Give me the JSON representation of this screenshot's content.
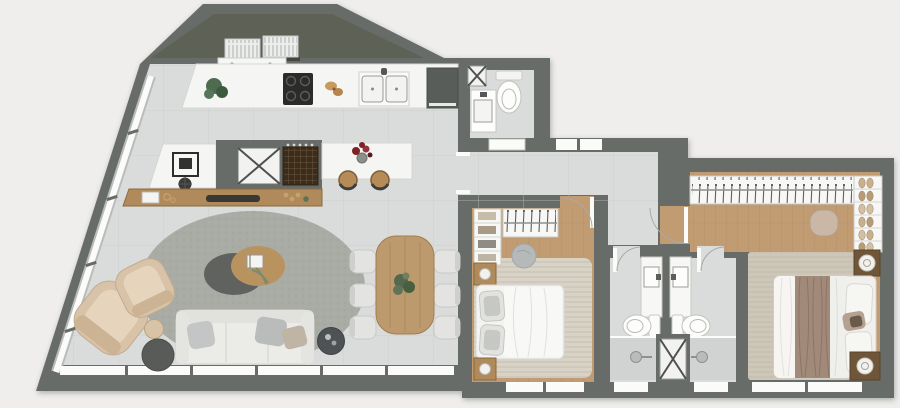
{
  "meta": {
    "title": "Apartment floor plan – rendered top view, no text labels",
    "canvas": {
      "width": 900,
      "height": 408
    }
  },
  "palette": {
    "bg": "#efeeec",
    "wall": "#686c68",
    "tile": "#dadcdb",
    "tile_line": "#c7cac9",
    "wood": "#c19b72",
    "wood_line": "#ad8a61",
    "service_floor": "#5e6156",
    "counter": "#f5f5f3",
    "counter_edge": "#d6d6d2",
    "rug_gray": "#a9aba5",
    "rug_beige": "#d8d3c5",
    "rug_master": "#cdc7b8",
    "white_furniture": "#f4f4f2",
    "sofa": "#ebebe8",
    "armchair": "#d9c3a8",
    "wood_furniture": "#b08a5a",
    "dark_accent": "#54575a",
    "green_plant": "#4e6b4f",
    "red_flowers": "#7e2125",
    "gold": "#c2a36b",
    "window": "#fbfbfa",
    "bed_throw": "#a18a79",
    "wine_rack": "#3a2d1e"
  },
  "inventory": {
    "rooms": [
      {
        "id": "service-area",
        "items": [
          "ac-condenser-1",
          "ac-condenser-2",
          "wall-shelf"
        ]
      },
      {
        "id": "kitchen",
        "items": [
          "countertop",
          "hood-shelf",
          "potted-plant",
          "cooktop",
          "bread",
          "double-sink",
          "refrigerator"
        ]
      },
      {
        "id": "powder-room",
        "items": [
          "toilet",
          "washbasin",
          "shaft"
        ]
      },
      {
        "id": "island-area",
        "items": [
          "side-counter",
          "coffee-station",
          "counter-stool",
          "utility-cabinet",
          "wine-rack",
          "island-counter",
          "flower-vase",
          "bar-stool-1",
          "bar-stool-2"
        ]
      },
      {
        "id": "living-room",
        "items": [
          "sideboard",
          "soundbar",
          "decor-objects",
          "area-rug",
          "sofa",
          "throw-pillows",
          "armchair-1",
          "armchair-2",
          "side-table",
          "ottoman",
          "planter",
          "coffee-table",
          "book",
          "leaf-decor"
        ]
      },
      {
        "id": "dining-area",
        "items": [
          "dining-table",
          "centerpiece-plant",
          "dining-chair-1",
          "dining-chair-2",
          "dining-chair-3",
          "dining-chair-4",
          "dining-chair-5",
          "dining-chair-6"
        ]
      },
      {
        "id": "bedroom-1",
        "items": [
          "shelf-unit",
          "wardrobe-hangers",
          "pouf",
          "nightstand-1",
          "nightstand-2",
          "double-bed",
          "area-rug"
        ]
      },
      {
        "id": "bathroom-1",
        "items": [
          "vanity-sink",
          "toilet",
          "shower"
        ]
      },
      {
        "id": "bathroom-2",
        "items": [
          "vanity-sink",
          "toilet",
          "shower"
        ]
      },
      {
        "id": "master-bedroom",
        "items": [
          "hanger-rail",
          "shoe-shelves",
          "pouf",
          "area-rug",
          "double-bed",
          "nightstand-1",
          "nightstand-2"
        ]
      }
    ],
    "openings": [
      "entry-window-band",
      "powder-door",
      "bedroom-1-door",
      "master-door",
      "bathroom-1-door",
      "bathroom-2-door",
      "living-window-band",
      "bedroom-1-window",
      "bathroom-1-window",
      "bathroom-2-window",
      "master-window",
      "diagonal-glazing"
    ]
  }
}
